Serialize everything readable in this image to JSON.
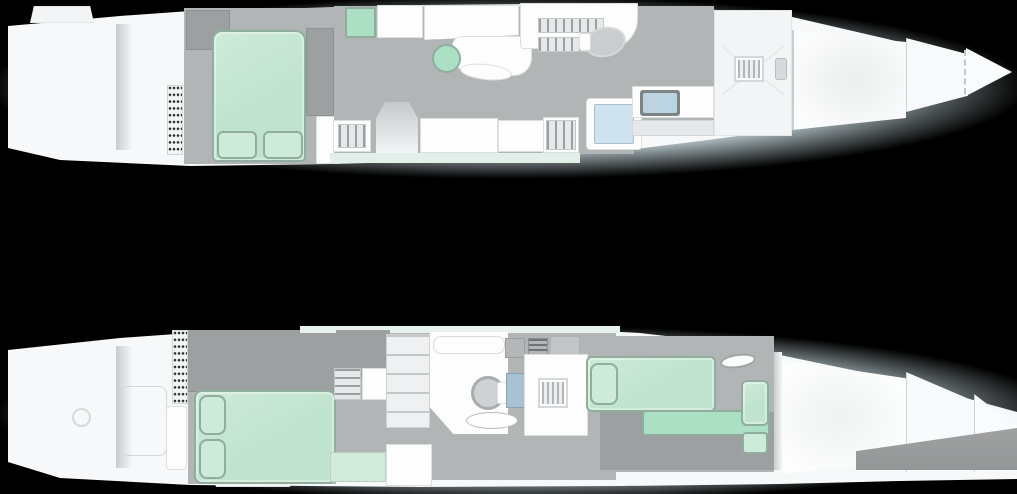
{
  "title": "",
  "colors": {
    "background": "#000000",
    "water_halo": "#d8ebf1",
    "hull_white": "#f6f8f9",
    "deck_white": "#f2f4f5",
    "panel_white": "#fdfdfd",
    "floor_gray": "#b2b5b6",
    "floor_dark_gray": "#9da0a1",
    "wall_gray": "#c9cccd",
    "furniture_green": "#bfe3ce",
    "furniture_green_light": "#cdeada",
    "furniture_green_medium": "#abe0c5",
    "furniture_green_strip": "#d2ead9",
    "glass_blue": "#cfe3ef",
    "steel_blue": "#a9c2d2",
    "laptop_screen_blue": "#bcd3e2",
    "grate_dot": "#2e2f2f",
    "green_trim": "#8fae9d"
  },
  "decks": {
    "upper": {
      "id": "upper-deck-plan",
      "features": [
        "stern-deck",
        "crew-grate",
        "master-cabin",
        "double-bed-with-pillows",
        "wardrobes",
        "green-locker",
        "galley-cabinets",
        "dinette-round-table",
        "dinette-bench",
        "staircases",
        "toilet",
        "shower-cabin",
        "desk-with-laptop",
        "foredeck-hatch",
        "anchor-windlass",
        "bow-cabin",
        "bow-tip"
      ]
    },
    "lower": {
      "id": "lower-deck-plan",
      "features": [
        "stern-deck",
        "deck-hatch-circle",
        "crew-grate",
        "sideboard",
        "master-cabin",
        "double-bed-with-pillows",
        "staircase",
        "shelving-unit",
        "bathroom",
        "toilet",
        "bathtub-oval",
        "shower-panel",
        "corridor-hatch",
        "bow-lounge-sunpad",
        "chaise-extension",
        "deck-oval-hatch",
        "forepeak",
        "hull-bow-cutoff"
      ]
    }
  }
}
